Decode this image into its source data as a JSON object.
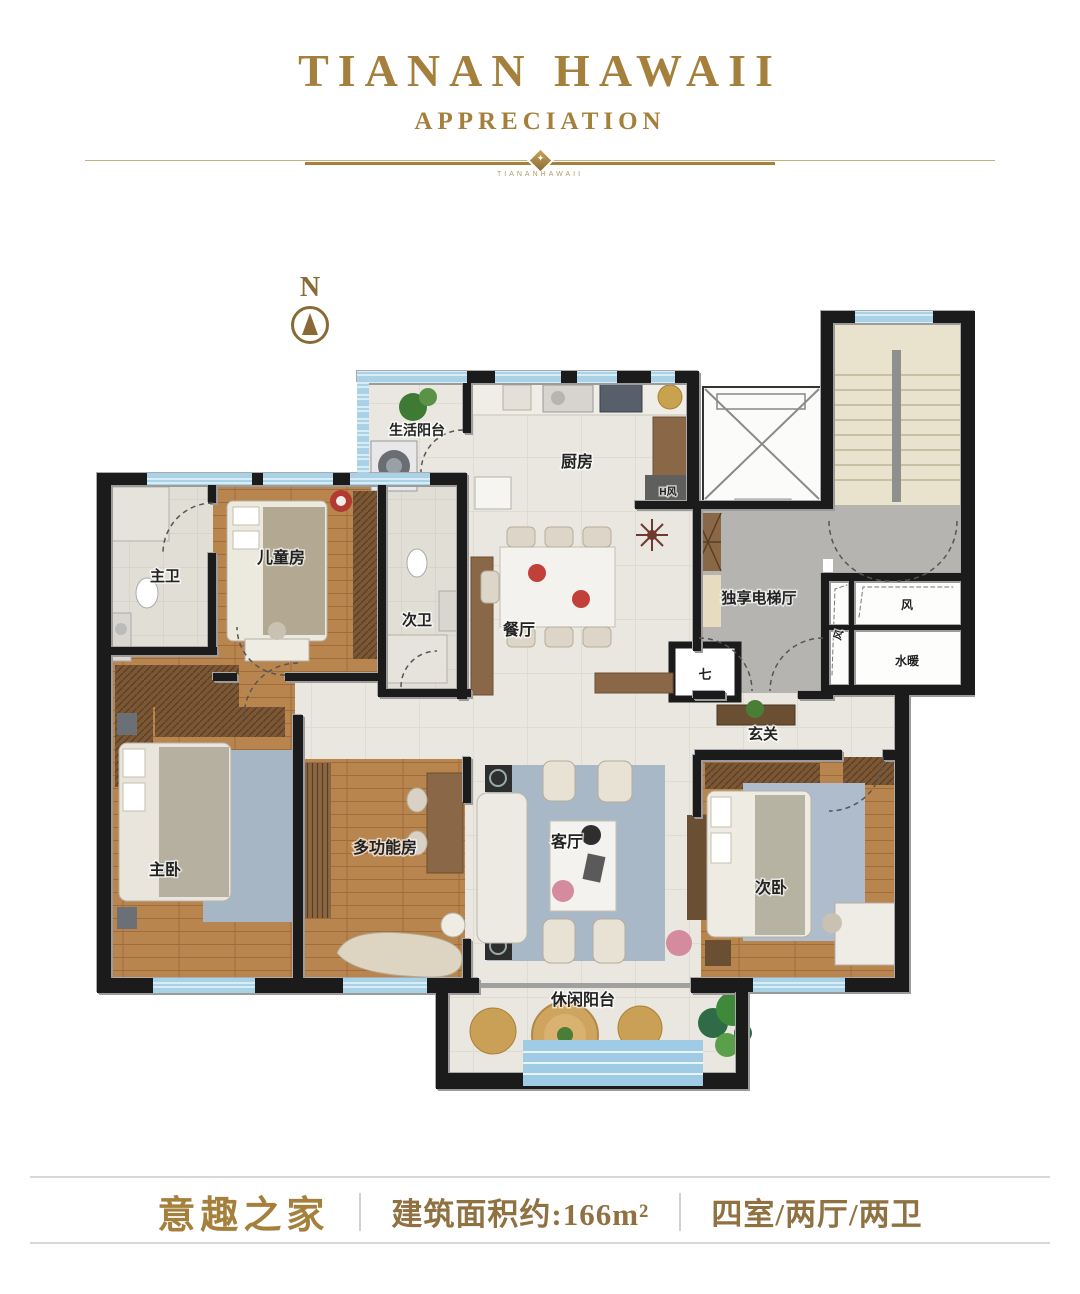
{
  "header": {
    "title": "TIANAN HAWAII",
    "subtitle": "APPRECIATION",
    "ornament_star": "✦",
    "ornament_caption": "TIANANHAWAII"
  },
  "compass": {
    "label": "N"
  },
  "rooms": {
    "service_balcony": "生活阳台",
    "kitchen": "厨房",
    "master_bath": "主卫",
    "kids_room": "儿童房",
    "second_bath": "次卫",
    "dining": "餐厅",
    "elevator_hall": "独享电梯厅",
    "foyer": "玄关",
    "master_bedroom": "主卧",
    "multi_function": "多功能房",
    "living_room": "客厅",
    "second_bedroom": "次卧",
    "leisure_balcony": "休闲阳台",
    "air_shaft": "风",
    "air_shaft_side": "风",
    "plumbing_shaft": "水暖",
    "flue_mark": "七",
    "exhaust_mark": "H风"
  },
  "footer": {
    "name": "意趣之家",
    "area": "建筑面积约:166m²",
    "layout": "四室/两厅/两卫"
  },
  "colors": {
    "gold": "#a5803c",
    "gold-dark": "#8a6a34",
    "wall": "#1b1b1b",
    "window": "#a9d2e6",
    "tile": "#e9e7e0",
    "wood": "#b9854f",
    "gray-floor": "#b6b4b1",
    "stair": "#e9e2cc",
    "rug": "#a9b8c6",
    "divider": "#d9d8d4"
  }
}
